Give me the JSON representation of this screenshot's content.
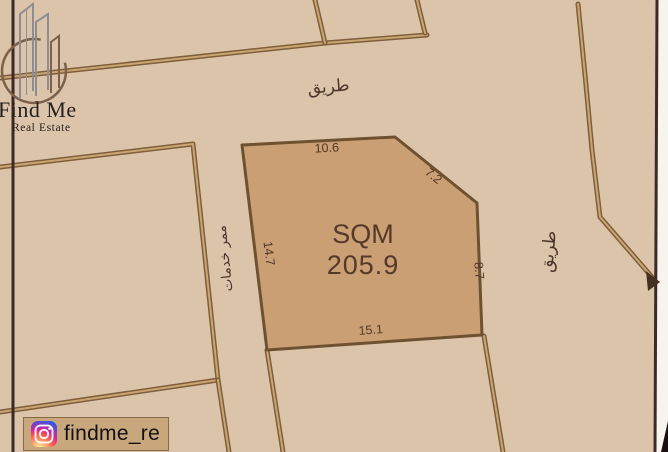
{
  "brand": {
    "name_line1": "Find Me",
    "name_line2": "Real Estate",
    "instagram_handle": "findme_re"
  },
  "map": {
    "width": 668,
    "height": 452,
    "colors": {
      "background": "#dcc4ab",
      "road_edge": "#7e5e3b",
      "road_center": "#c9a672",
      "parcel_fill": "#cb9f74",
      "parcel_stroke": "#6e5130",
      "boundary_dark": "#3e2a25",
      "street_text": "#4a332a",
      "dim_text": "#503626",
      "area_text": "#54382a",
      "edge_white": "#f7f3ee",
      "corner_wedge": "#1a0e10",
      "arrow": "#46301f"
    },
    "parcel": {
      "name": "plot-sqm-205.9",
      "points": [
        [
          242,
          145
        ],
        [
          395,
          137
        ],
        [
          477,
          203
        ],
        [
          482,
          335
        ],
        [
          267,
          350
        ]
      ],
      "area_label": "SQM",
      "area_value": "205.9",
      "area_x": 363,
      "area_label_y": 243,
      "area_value_y": 274,
      "dimensions": [
        {
          "value": "10.6",
          "x": 327,
          "y": 152,
          "rotate": -3
        },
        {
          "value": "7.2",
          "x": 431,
          "y": 179,
          "rotate": 39
        },
        {
          "value": "8.7",
          "x": 475,
          "y": 271,
          "rotate": 85
        },
        {
          "value": "15.1",
          "x": 371,
          "y": 334,
          "rotate": -4
        },
        {
          "value": "14.7",
          "x": 265,
          "y": 254,
          "rotate": 83
        }
      ]
    },
    "street_labels": [
      {
        "name": "road-label-top",
        "text": "طريق",
        "x": 329,
        "y": 92,
        "rotate": -5,
        "size": 17
      },
      {
        "name": "road-label-right",
        "text": "طريق",
        "x": 554,
        "y": 252,
        "rotate": -85,
        "size": 17
      },
      {
        "name": "service-corridor-label",
        "text": "ممر خدمات",
        "x": 229,
        "y": 258,
        "rotate": -96,
        "size": 13.5
      }
    ],
    "road_lines": [
      {
        "name": "top-road-edge",
        "points": [
          [
            0,
            78
          ],
          [
            325,
            43
          ],
          [
            427,
            35
          ]
        ]
      },
      {
        "name": "top-plot-divider-1",
        "points": [
          [
            315,
            0
          ],
          [
            325,
            43
          ]
        ]
      },
      {
        "name": "top-plot-divider-2",
        "points": [
          [
            417,
            0
          ],
          [
            425,
            33
          ]
        ]
      },
      {
        "name": "left-plot-boundary",
        "points": [
          [
            0,
            167
          ],
          [
            193,
            144
          ],
          [
            218,
            380
          ],
          [
            0,
            412
          ]
        ]
      },
      {
        "name": "corridor-left-extension",
        "points": [
          [
            218,
            380
          ],
          [
            229,
            452
          ]
        ]
      },
      {
        "name": "corridor-right-extension",
        "points": [
          [
            267,
            350
          ],
          [
            283,
            452
          ]
        ]
      },
      {
        "name": "parcel-right-extension",
        "points": [
          [
            484,
            336
          ],
          [
            503,
            452
          ]
        ]
      },
      {
        "name": "right-road-line",
        "points": [
          [
            578,
            4
          ],
          [
            586,
            85
          ],
          [
            592,
            150
          ],
          [
            600,
            217
          ],
          [
            658,
            284
          ]
        ]
      }
    ],
    "dark_lines": [
      {
        "name": "left-boundary-dark",
        "points": [
          [
            13,
            0
          ],
          [
            13,
            452
          ]
        ]
      },
      {
        "name": "right-boundary-dark",
        "points": [
          [
            657,
            0
          ],
          [
            655,
            452
          ]
        ]
      }
    ],
    "white_edge": [
      [
        658,
        0
      ],
      [
        668,
        0
      ],
      [
        668,
        452
      ],
      [
        656,
        452
      ]
    ],
    "corner_wedge": [
      [
        661,
        452
      ],
      [
        668,
        421
      ],
      [
        668,
        452
      ]
    ],
    "road_arrow": [
      [
        646,
        271
      ],
      [
        660,
        282
      ],
      [
        648,
        291
      ]
    ]
  }
}
